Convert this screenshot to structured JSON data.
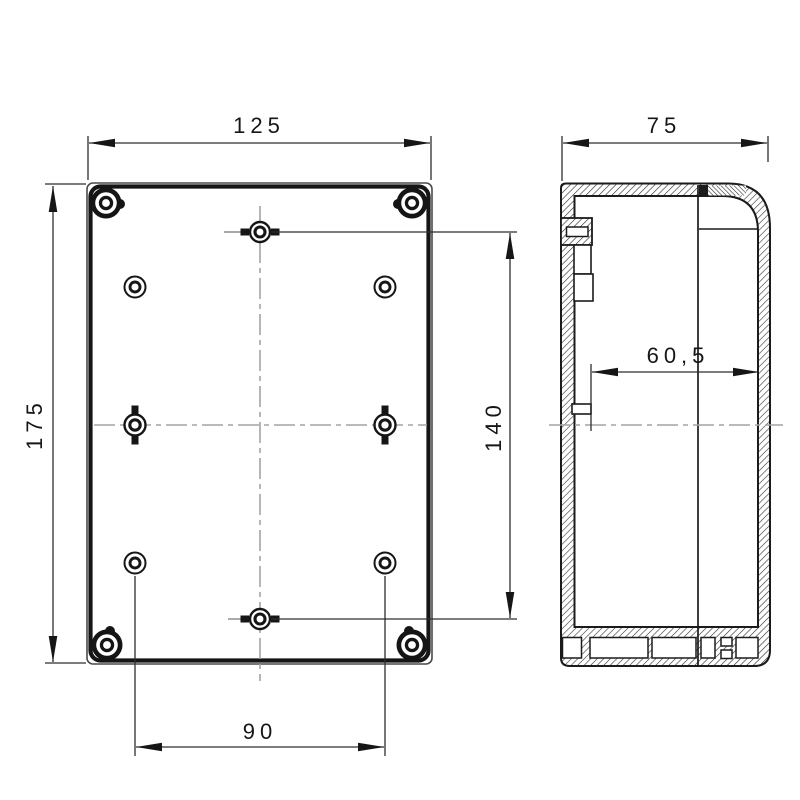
{
  "drawing": {
    "kind": "enclosure-technical-drawing",
    "views": {
      "front_view_name": "front-view",
      "side_view_name": "side-section-view"
    }
  },
  "dimensions": {
    "front_view": {
      "overall_width": "125",
      "overall_height": "175",
      "hole_spacing_vertical": "140",
      "hole_spacing_horizontal": "90"
    },
    "side_view": {
      "overall_depth": "75",
      "inner_depth": "60,5"
    }
  },
  "colors": {
    "background": "#ffffff",
    "outline": "#161616",
    "thin_line": "#3a3a3a",
    "centerline": "#a3a3a3",
    "hatch": "#2a2a2a"
  }
}
